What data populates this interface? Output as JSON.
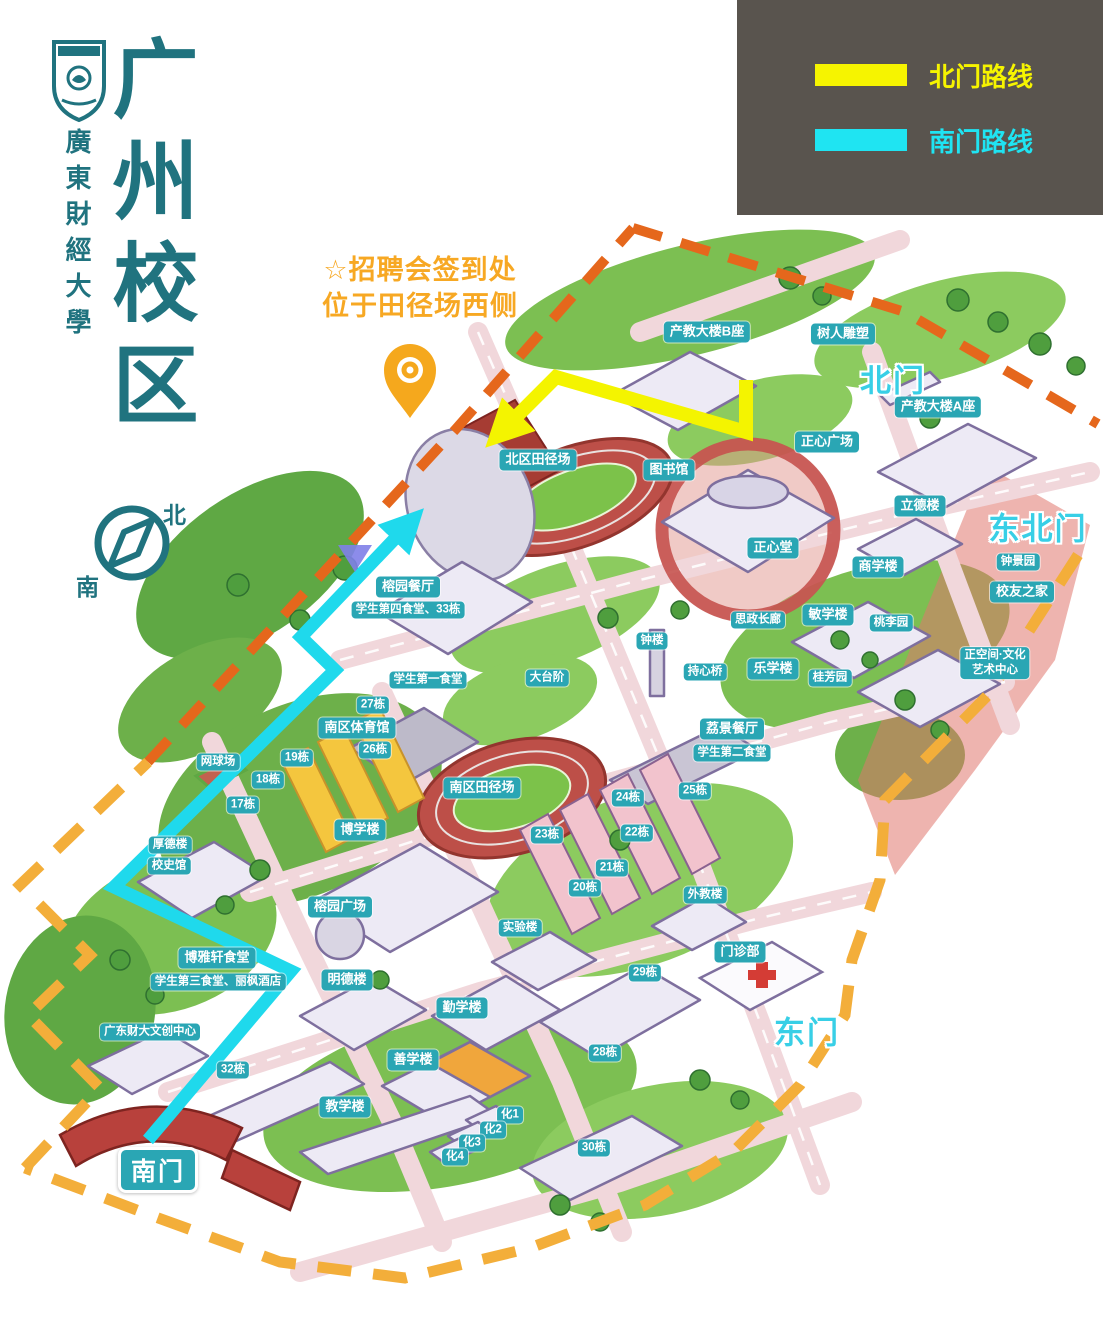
{
  "page": {
    "width": 1103,
    "height": 1326,
    "background": "#ffffff"
  },
  "branding": {
    "logo": "university-seal",
    "university_name": "廣東財經大學",
    "campus_title": "广州校区",
    "title_color": "#20737f"
  },
  "legend": {
    "background": "#59544e",
    "items": [
      {
        "label": "北门路线",
        "color": "#f6f400"
      },
      {
        "label": "南门路线",
        "color": "#1fe4f2"
      }
    ]
  },
  "annotation": {
    "line1": "☆招聘会签到处",
    "line2": "位于田径场西侧",
    "color": "#f7a823",
    "pin_icon": "orange-map-pin"
  },
  "compass": {
    "north": "北",
    "south": "南",
    "color": "#20737f"
  },
  "routes": {
    "north": {
      "name": "北门路线",
      "color": "#f4f400",
      "points": "746,380 746,432 556,377 505,428"
    },
    "south": {
      "name": "南门路线",
      "color": "#1fd9ec",
      "points": "148,1140 291,971 114,887 335,670 301,637 406,527"
    }
  },
  "boundary": {
    "northwest_color": "#e5671c",
    "southeast_color": "#f3ae3a"
  },
  "map": {
    "label_bg": "#2aa6b4",
    "labels": [
      {
        "t": "产教大楼B座",
        "x": 707,
        "y": 332
      },
      {
        "t": "树人雕塑",
        "x": 843,
        "y": 334
      },
      {
        "t": "产教大楼A座",
        "x": 938,
        "y": 407
      },
      {
        "t": "正心广场",
        "x": 827,
        "y": 442
      },
      {
        "t": "北区田径场",
        "x": 538,
        "y": 460
      },
      {
        "t": "图书馆",
        "x": 669,
        "y": 470
      },
      {
        "t": "立德楼",
        "x": 920,
        "y": 506
      },
      {
        "t": "正心堂",
        "x": 773,
        "y": 548
      },
      {
        "t": "商学楼",
        "x": 878,
        "y": 567
      },
      {
        "t": "钟景园",
        "x": 1018,
        "y": 562,
        "kind": "small"
      },
      {
        "t": "校友之家",
        "x": 1022,
        "y": 592
      },
      {
        "t": "榕园餐厅",
        "x": 408,
        "y": 587
      },
      {
        "t": "学生第四食堂、33栋",
        "x": 408,
        "y": 610,
        "kind": "small"
      },
      {
        "t": "思政长廊",
        "x": 758,
        "y": 620,
        "kind": "small"
      },
      {
        "t": "敏学楼",
        "x": 828,
        "y": 615
      },
      {
        "t": "桃李园",
        "x": 891,
        "y": 623,
        "kind": "small"
      },
      {
        "t": "钟楼",
        "x": 652,
        "y": 641,
        "kind": "small"
      },
      {
        "t": "正空间·文化\n艺术中心",
        "x": 995,
        "y": 663,
        "kind": "small"
      },
      {
        "t": "持心桥",
        "x": 705,
        "y": 672,
        "kind": "small"
      },
      {
        "t": "乐学楼",
        "x": 773,
        "y": 669
      },
      {
        "t": "桂芳园",
        "x": 830,
        "y": 678,
        "kind": "small"
      },
      {
        "t": "学生第一食堂",
        "x": 428,
        "y": 680,
        "kind": "small"
      },
      {
        "t": "大台阶",
        "x": 547,
        "y": 678,
        "kind": "small"
      },
      {
        "t": "27栋",
        "x": 373,
        "y": 705,
        "kind": "small"
      },
      {
        "t": "南区体育馆",
        "x": 357,
        "y": 728
      },
      {
        "t": "26栋",
        "x": 375,
        "y": 750,
        "kind": "small"
      },
      {
        "t": "荔景餐厅",
        "x": 732,
        "y": 729
      },
      {
        "t": "学生第二食堂",
        "x": 732,
        "y": 753,
        "kind": "small"
      },
      {
        "t": "网球场",
        "x": 218,
        "y": 762,
        "kind": "small"
      },
      {
        "t": "19栋",
        "x": 297,
        "y": 758,
        "kind": "small"
      },
      {
        "t": "18栋",
        "x": 268,
        "y": 780,
        "kind": "small"
      },
      {
        "t": "25栋",
        "x": 695,
        "y": 791,
        "kind": "small"
      },
      {
        "t": "24栋",
        "x": 628,
        "y": 798,
        "kind": "small"
      },
      {
        "t": "17栋",
        "x": 243,
        "y": 805,
        "kind": "small"
      },
      {
        "t": "南区田径场",
        "x": 482,
        "y": 788
      },
      {
        "t": "23栋",
        "x": 547,
        "y": 835,
        "kind": "small"
      },
      {
        "t": "22栋",
        "x": 637,
        "y": 833,
        "kind": "small"
      },
      {
        "t": "博学楼",
        "x": 360,
        "y": 830
      },
      {
        "t": "21栋",
        "x": 612,
        "y": 868,
        "kind": "small"
      },
      {
        "t": "20栋",
        "x": 585,
        "y": 888,
        "kind": "small"
      },
      {
        "t": "外教楼",
        "x": 705,
        "y": 895,
        "kind": "small"
      },
      {
        "t": "厚德楼",
        "x": 170,
        "y": 845,
        "kind": "small"
      },
      {
        "t": "校史馆",
        "x": 169,
        "y": 866,
        "kind": "small"
      },
      {
        "t": "榕园广场",
        "x": 340,
        "y": 907
      },
      {
        "t": "实验楼",
        "x": 520,
        "y": 928,
        "kind": "small"
      },
      {
        "t": "门诊部",
        "x": 740,
        "y": 952
      },
      {
        "t": "博雅轩食堂",
        "x": 217,
        "y": 958
      },
      {
        "t": "学生第三食堂、丽枫酒店",
        "x": 218,
        "y": 982,
        "kind": "small"
      },
      {
        "t": "29栋",
        "x": 645,
        "y": 973,
        "kind": "small"
      },
      {
        "t": "明德楼",
        "x": 347,
        "y": 980
      },
      {
        "t": "勤学楼",
        "x": 462,
        "y": 1008
      },
      {
        "t": "广东财大文创中心",
        "x": 150,
        "y": 1032,
        "kind": "small"
      },
      {
        "t": "善学楼",
        "x": 413,
        "y": 1060
      },
      {
        "t": "28栋",
        "x": 605,
        "y": 1053,
        "kind": "small"
      },
      {
        "t": "32栋",
        "x": 233,
        "y": 1070,
        "kind": "small"
      },
      {
        "t": "教学楼",
        "x": 345,
        "y": 1107
      },
      {
        "t": "化1",
        "x": 510,
        "y": 1115,
        "kind": "small"
      },
      {
        "t": "化2",
        "x": 493,
        "y": 1130,
        "kind": "small"
      },
      {
        "t": "化3",
        "x": 472,
        "y": 1143,
        "kind": "small"
      },
      {
        "t": "化4",
        "x": 455,
        "y": 1157,
        "kind": "small"
      },
      {
        "t": "30栋",
        "x": 594,
        "y": 1148,
        "kind": "small"
      }
    ],
    "gates": [
      {
        "t": "北门",
        "x": 893,
        "y": 378,
        "kind": "gate"
      },
      {
        "t": "东北门",
        "x": 1038,
        "y": 526,
        "kind": "gate"
      },
      {
        "t": "东门",
        "x": 807,
        "y": 1030,
        "kind": "gate"
      },
      {
        "t": "南门",
        "x": 158,
        "y": 1170,
        "kind": "gatepill"
      }
    ]
  }
}
